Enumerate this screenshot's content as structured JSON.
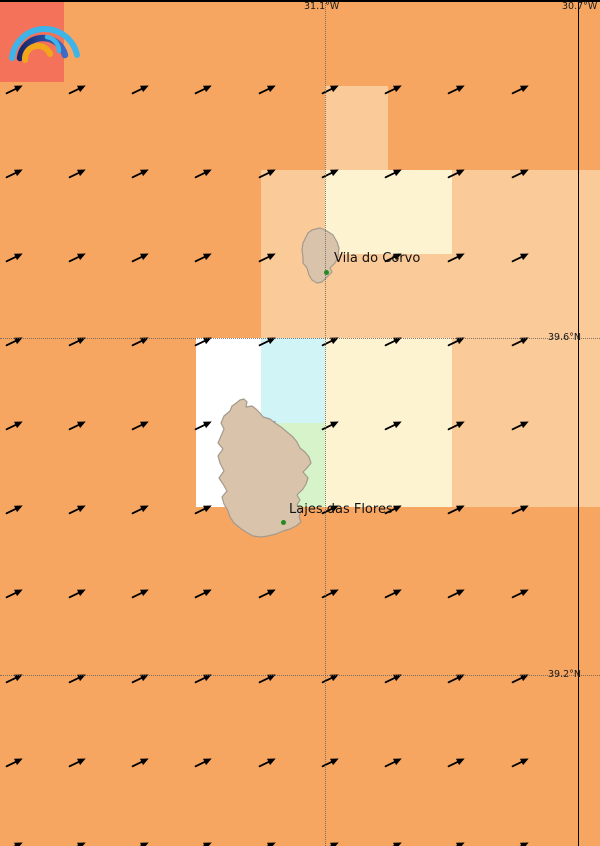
{
  "map": {
    "width": 600,
    "height": 846,
    "colors": {
      "base": "#F7A661",
      "peach": "#FACA98",
      "cream": "#FDF3D0",
      "cyan": "#D1F5F7",
      "green": "#D6F3C9",
      "white": "#FFFFFF",
      "logo_red": "#F4715A",
      "island_fill": "#D9C4AB",
      "island_stroke": "#A39A8E",
      "arrow": "#000000",
      "dot_green": "#228B22",
      "grid_dotted": "#5A5A5A",
      "grid_solid": "#000000",
      "label_text": "#1A1A1A"
    },
    "coordinate_labels": {
      "lon_left": "31.1°W",
      "lon_right": "30.7°W",
      "lat_top": "39.6°N",
      "lat_bottom": "39.2°N"
    },
    "places": [
      {
        "name": "Vila do Corvo",
        "label_x": 334,
        "label_y": 251,
        "dot_x": 326,
        "dot_y": 272
      },
      {
        "name": "Lajes das Flores",
        "label_x": 289,
        "label_y": 502,
        "dot_x": 283,
        "dot_y": 522
      }
    ],
    "cells": [
      {
        "x": 0,
        "y": 2,
        "w": 64,
        "h": 80,
        "color": "logo_red",
        "name": "logo-background-cell"
      },
      {
        "x": 325,
        "y": 86,
        "w": 63,
        "h": 84,
        "color": "peach"
      },
      {
        "x": 261,
        "y": 170,
        "w": 64,
        "h": 84,
        "color": "peach"
      },
      {
        "x": 325,
        "y": 170,
        "w": 127,
        "h": 84,
        "color": "cream"
      },
      {
        "x": 452,
        "y": 170,
        "w": 148,
        "h": 84,
        "color": "peach"
      },
      {
        "x": 261,
        "y": 254,
        "w": 339,
        "h": 84,
        "color": "peach"
      },
      {
        "x": 196,
        "y": 338,
        "w": 65,
        "h": 169,
        "color": "white"
      },
      {
        "x": 261,
        "y": 338,
        "w": 64,
        "h": 85,
        "color": "cyan"
      },
      {
        "x": 261,
        "y": 423,
        "w": 64,
        "h": 84,
        "color": "green"
      },
      {
        "x": 325,
        "y": 338,
        "w": 127,
        "h": 169,
        "color": "cream"
      },
      {
        "x": 452,
        "y": 338,
        "w": 148,
        "h": 169,
        "color": "peach"
      }
    ],
    "gridlines": {
      "vertical": [
        {
          "x": 325,
          "style": "dotted"
        },
        {
          "x": 578,
          "style": "solid"
        }
      ],
      "horizontal": [
        {
          "y": 0,
          "style": "solid"
        },
        {
          "y": 338,
          "style": "dotted"
        },
        {
          "y": 675,
          "style": "dotted"
        }
      ]
    },
    "wind_arrows": {
      "cols": [
        9,
        72,
        135,
        198,
        262,
        325,
        388,
        451,
        515
      ],
      "rows": [
        86,
        170,
        254,
        338,
        422,
        506,
        590,
        675,
        759,
        843
      ],
      "angle_deg": -26
    },
    "logo": {
      "name": "meteoblue-rainbow-logo",
      "arc_colors": {
        "outer": "#3EB4E8",
        "middle_start": "#15266B",
        "middle_end": "#3E6CC8",
        "inner_small": "#3EB4E8",
        "orange": "#F2A71B"
      }
    }
  }
}
